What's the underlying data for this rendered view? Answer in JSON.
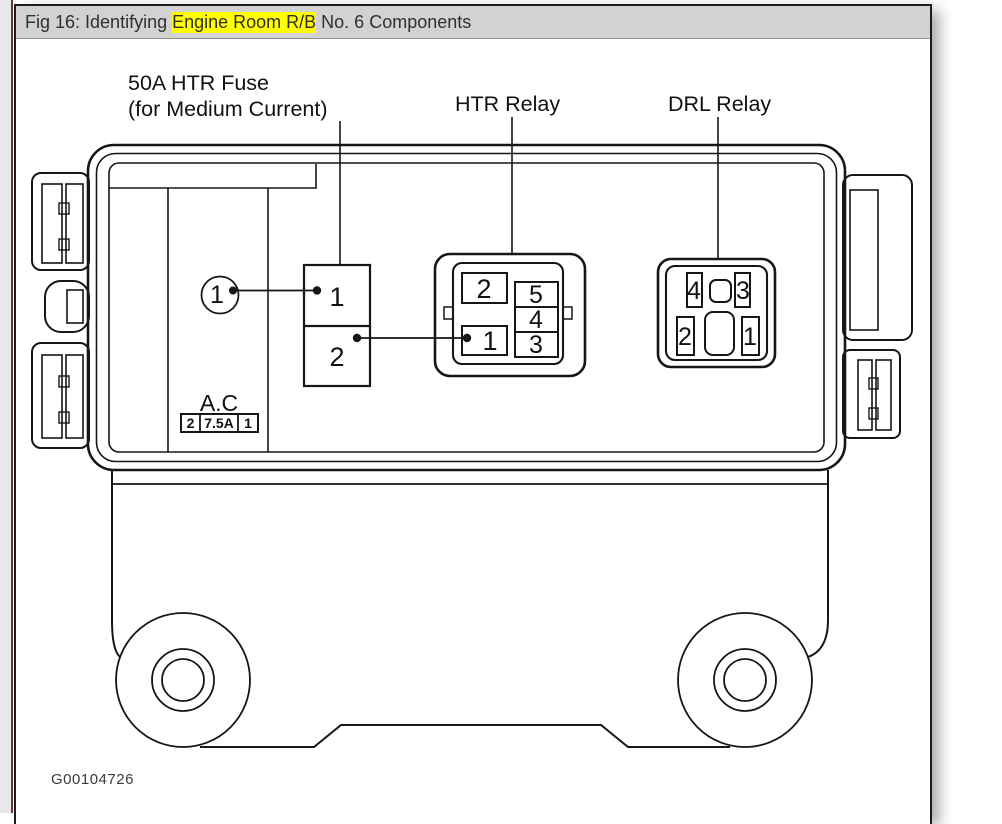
{
  "window": {
    "title_prefix": "Fig 16: Identifying ",
    "title_highlight": "Engine Room R/B",
    "title_suffix": " No. 6 Components"
  },
  "figure": {
    "code": "G00104726",
    "labels": {
      "fuse_line1": "50A HTR Fuse",
      "fuse_line2": "(for Medium Current)",
      "htr_relay": "HTR Relay",
      "drl_relay": "DRL Relay"
    },
    "callout_1": "1",
    "htr_fuse_block": {
      "cell_top": "1",
      "cell_bottom": "2"
    },
    "ac_block": {
      "label": "A.C",
      "fuse_cells": [
        "2",
        "7.5A",
        "1"
      ]
    },
    "htr_relay_connector": {
      "cell_2": "2",
      "cell_1": "1",
      "right_cells": [
        "5",
        "4",
        "3"
      ]
    },
    "drl_relay_connector": {
      "cells": [
        "4",
        "3",
        "2",
        "1"
      ]
    }
  },
  "colors": {
    "titlebar_bg": "#d2d2d2",
    "highlight": "#ffff00",
    "accent_left_line": "#6e3434",
    "ink": "#111111"
  }
}
